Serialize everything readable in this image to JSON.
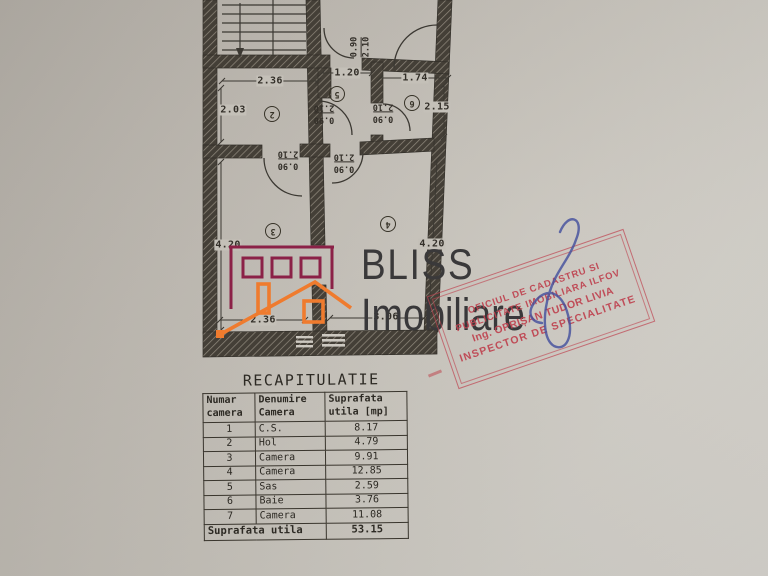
{
  "colors": {
    "stamp_red": "#bf4350",
    "logo_maroon": "#8b2147",
    "logo_orange": "#ef7b2e",
    "signature_blue": "#44509e",
    "ink": "#34312b"
  },
  "plan": {
    "dims": {
      "top_room2": "2.36",
      "top_sas": "1.20",
      "top_baie": "1.74",
      "left_room2": "2.03",
      "right_baie": "2.15",
      "left_room3": "4.20",
      "right_room4": "4.20",
      "bottom_room3": "2.36",
      "bottom_room4": "3.06"
    },
    "door": {
      "width": "0.90",
      "height": "2.10"
    },
    "rooms": {
      "hol": "2",
      "sas": "5",
      "baie": "6",
      "camera_left": "3",
      "camera_right": "4"
    }
  },
  "logo": {
    "name": "BLISS",
    "subname": "Imobiliare"
  },
  "stamp": {
    "line1": "OFICIUL DE CADASTRU SI",
    "line2": "PUBLICITATE IMOBILIARA ILFOV",
    "line3": "Ing. OPRIȘAN TUDOR LIVIA",
    "line4": "INSPECTOR DE SPECIALITATE"
  },
  "table": {
    "title": "RECAPITULATIE",
    "headers": [
      "Numar camera",
      "Denumire Camera",
      "Suprafata utila [mp]"
    ],
    "rows": [
      [
        "1",
        "C.S.",
        "8.17"
      ],
      [
        "2",
        "Hol",
        "4.79"
      ],
      [
        "3",
        "Camera",
        "9.91"
      ],
      [
        "4",
        "Camera",
        "12.85"
      ],
      [
        "5",
        "Sas",
        "2.59"
      ],
      [
        "6",
        "Baie",
        "3.76"
      ],
      [
        "7",
        "Camera",
        "11.08"
      ]
    ],
    "footer_label": "Suprafata utila",
    "footer_value": "53.15"
  }
}
